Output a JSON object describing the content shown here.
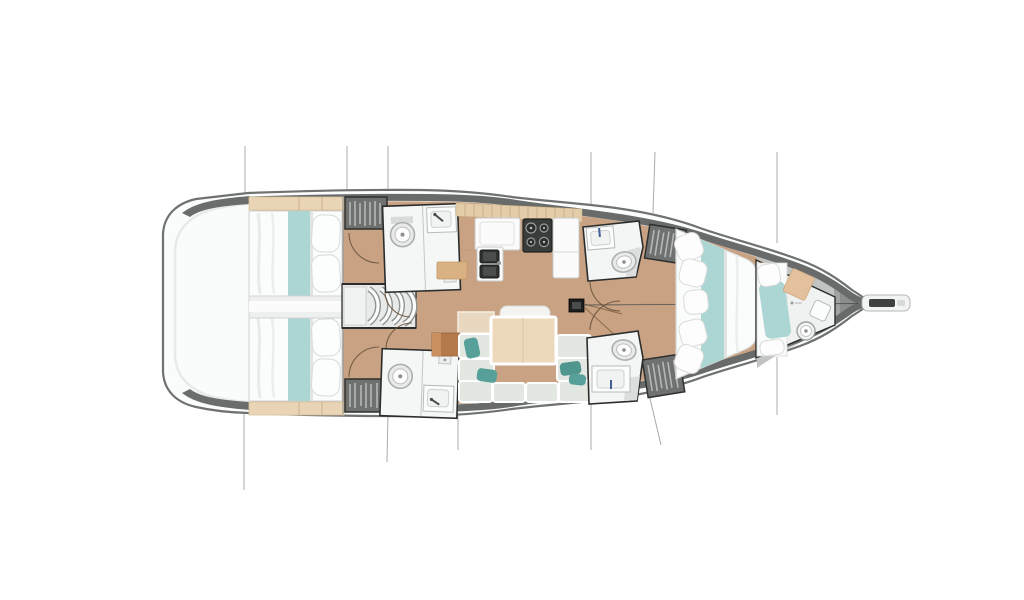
{
  "meta": {
    "title": "Sailing yacht interior deck plan, overhead view, bow pointing right",
    "view": "top-down floor plan drawing on white background",
    "background": "#ffffff"
  },
  "palette": {
    "hull_outline": "#6f7271",
    "gunwale_band": "#686b6a",
    "hull_white": "#fbfcfc",
    "transom_white": "#fafbfb",
    "deck_gray": "#e8e9e9",
    "wood_floor": "#c8a283",
    "wood_shelf": "#e9d4b6",
    "tile_counter": "#e3cca9",
    "bedding_white": "#fbfcfc",
    "bedding_teal": "#abd6d4",
    "cushion_gray": "#e3e7e2",
    "cushion_teal": "#57a099",
    "table_wood": "#ecd9bc",
    "chart_table_brown": "#b47a4c",
    "fixture_white": "#f5f6f6",
    "fixture_dark": "#3a3c3b",
    "locker_gray": "#6e716f",
    "outline_dark": "#2b2d2c",
    "guide_line": "#a9abaa",
    "door_arc": "#6b553f"
  },
  "rooms": [
    {
      "id": "swim-platform",
      "label": "stern swim platform / transom"
    },
    {
      "id": "aft-cabin-top",
      "label": "aft double cabin (top) with island bed"
    },
    {
      "id": "aft-cabin-bottom",
      "label": "aft double cabin (bottom) with island bed"
    },
    {
      "id": "companionway",
      "label": "companionway stairs, 4 curved steps"
    },
    {
      "id": "head-aft-top",
      "label": "aft head (top) with toilet, sink, shower"
    },
    {
      "id": "head-aft-bottom",
      "label": "aft head (bottom) with toilet, sink, shower"
    },
    {
      "id": "galley",
      "label": "galley with twin sinks, stove, counters"
    },
    {
      "id": "saloon",
      "label": "saloon with U-settee and folding table"
    },
    {
      "id": "head-fwd-top",
      "label": "forward head (top) with toilet and sink"
    },
    {
      "id": "head-fwd-bottom",
      "label": "forward head (bottom) with toilet and sink"
    },
    {
      "id": "owners-cabin",
      "label": "forward owner's cabin with V double bed"
    },
    {
      "id": "bow-cabin",
      "label": "bow peak cabin with berth, toilet and basin"
    },
    {
      "id": "bowsprit",
      "label": "bowsprit / anchor fitting"
    }
  ],
  "fixtures": {
    "toilets": 5,
    "sinks": 6,
    "hanging_lockers": 4,
    "stove_burners": 4,
    "beds": 4,
    "mast_step": 1
  }
}
